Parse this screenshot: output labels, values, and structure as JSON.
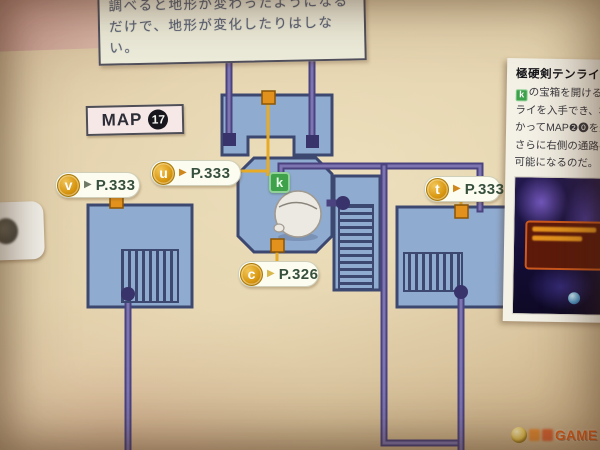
{
  "note_box": {
    "line1": "調べると地形が変わったようになる",
    "line2": "だけで、地形が変化したりはしない。"
  },
  "map_label": {
    "prefix": "MAP",
    "number": "17"
  },
  "pills": {
    "v": {
      "letter": "v",
      "arrow": "▶",
      "page": "P.333"
    },
    "u": {
      "letter": "u",
      "arrow": "▶",
      "page": "P.333"
    },
    "t": {
      "letter": "t",
      "arrow": "▶",
      "page": "P.333"
    },
    "c": {
      "letter": "c",
      "arrow": "▶",
      "page": "P.326"
    }
  },
  "k_badge": {
    "letter": "k"
  },
  "sidebar": {
    "title": "極硬剣テンライを入手",
    "badge_letter": "k",
    "lines": [
      "の宝箱を開けると極硬剣テン",
      "ライを入手でき、右側に向",
      "かってMAP❷⓿を進めば、",
      "さらに右側の通路へ移動が",
      "可能になるのだ。"
    ]
  },
  "watermark": {
    "text": "GAME"
  },
  "colors": {
    "room_fill": "#8fabd0",
    "room_border": "#3d4870",
    "corridor_purple": "#4a4380",
    "marker_orange": "#e2921c",
    "line_yellow": "#e7ab25",
    "key_green": "#3fa24b",
    "circle_gold": "#d8960f"
  }
}
